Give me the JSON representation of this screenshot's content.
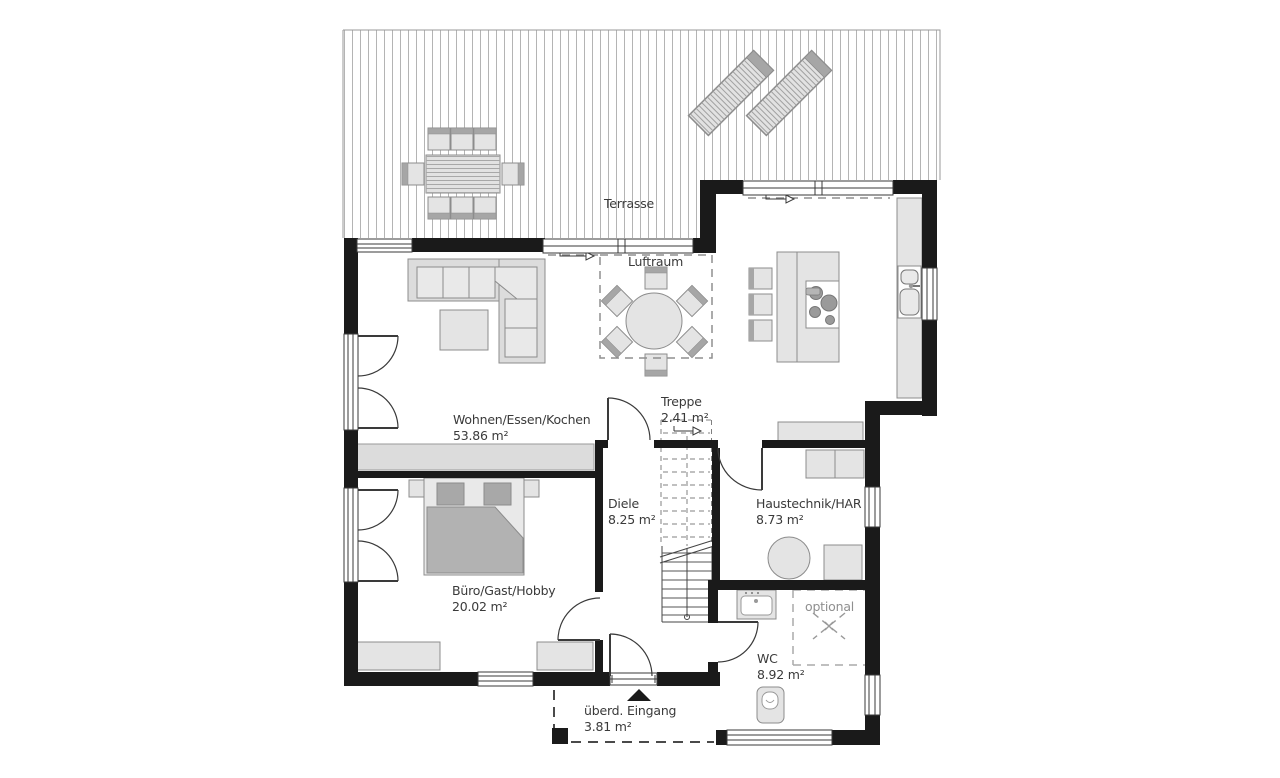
{
  "plan": {
    "title": "Erdgeschoss Grundriss",
    "rooms": {
      "terrasse": {
        "label": "Terrasse"
      },
      "luftraum": {
        "label": "Luftraum"
      },
      "treppe": {
        "label": "Treppe",
        "area": "2.41 m²"
      },
      "wohnen": {
        "label": "Wohnen/Essen/Kochen",
        "area": "53.86 m²"
      },
      "diele": {
        "label": "Diele",
        "area": "8.25 m²"
      },
      "haustechnik": {
        "label": "Haustechnik/HAR",
        "area": "8.73 m²"
      },
      "buero": {
        "label": "Büro/Gast/Hobby",
        "area": "20.02 m²"
      },
      "wc": {
        "label": "WC",
        "area": "8.92 m²"
      },
      "optional": {
        "label": "optional"
      },
      "eingang": {
        "label": "überd. Eingang",
        "area": "3.81 m²"
      }
    },
    "colors": {
      "wall": "#1a1a1a",
      "furniture": "#e4e4e4",
      "furniture_dark": "#a6a6a6",
      "blanket": "#b2b2b2",
      "deck_line": "#b4b4b4",
      "text": "#3a3a3a",
      "dashed": "#8f8f8f"
    }
  }
}
